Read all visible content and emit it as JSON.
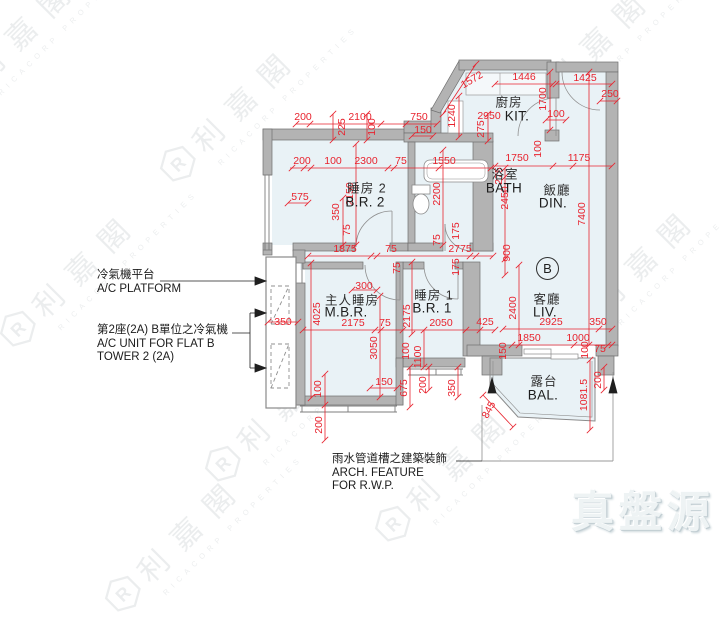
{
  "watermark": {
    "logo_letter": "R",
    "company_zh": "利嘉閣",
    "company_en": "RICACORP PROPERTIES"
  },
  "brand": {
    "logo_text": "真盤源"
  },
  "unit_badge": "B",
  "annotations": {
    "ac_platform_zh": "冷氣機平台",
    "ac_platform_en": "A/C PLATFORM",
    "ac_unit_zh": "第2座(2A) B單位之冷氣機",
    "ac_unit_en1": "A/C UNIT FOR FLAT B",
    "ac_unit_en2": "TOWER 2 (2A)",
    "arch_zh": "雨水管道槽之建築裝飾",
    "arch_en1": "ARCH. FEATURE",
    "arch_en2": "FOR R.W.P."
  },
  "rooms": [
    {
      "zh": "廚房",
      "zx": 509,
      "zy": 101,
      "en": "KIT.",
      "ex": 517,
      "ey": 116
    },
    {
      "zh": "睡房 2",
      "zx": 367,
      "zy": 187,
      "en": "B.R. 2",
      "ex": 365,
      "ey": 202
    },
    {
      "zh": "浴室",
      "zx": 505,
      "zy": 173,
      "en": "BATH",
      "ex": 504,
      "ey": 188
    },
    {
      "zh": "飯廳",
      "zx": 557,
      "zy": 189,
      "en": "DIN.",
      "ex": 553,
      "ey": 203
    },
    {
      "zh": "主人睡房",
      "zx": 352,
      "zy": 299,
      "en": "M.B.R.",
      "ex": 346,
      "ey": 312
    },
    {
      "zh": "睡房 1",
      "zx": 434,
      "zy": 294,
      "en": "B.R. 1",
      "ex": 432,
      "ey": 308
    },
    {
      "zh": "客廳",
      "zx": 547,
      "zy": 298,
      "en": "LIV.",
      "ex": 545,
      "ey": 312
    },
    {
      "zh": "露台",
      "zx": 544,
      "zy": 380,
      "en": "BAL.",
      "ex": 543,
      "ey": 395
    }
  ],
  "dimensions": [
    {
      "v": "200",
      "x": 303,
      "y": 117
    },
    {
      "v": "2100",
      "x": 360,
      "y": 117
    },
    {
      "v": "750",
      "x": 419,
      "y": 117
    },
    {
      "v": "225",
      "x": 342,
      "y": 127,
      "r": -90
    },
    {
      "v": "100",
      "x": 372,
      "y": 127,
      "r": -90
    },
    {
      "v": "150",
      "x": 423,
      "y": 130
    },
    {
      "v": "1572",
      "x": 472,
      "y": 80,
      "r": -30
    },
    {
      "v": "1446",
      "x": 524,
      "y": 77
    },
    {
      "v": "1425",
      "x": 585,
      "y": 78
    },
    {
      "v": "250",
      "x": 610,
      "y": 94
    },
    {
      "v": "1240",
      "x": 452,
      "y": 116,
      "r": -90
    },
    {
      "v": "2950",
      "x": 489,
      "y": 116
    },
    {
      "v": "275",
      "x": 481,
      "y": 129,
      "r": -90
    },
    {
      "v": "1700",
      "x": 543,
      "y": 99,
      "r": -90
    },
    {
      "v": "100",
      "x": 556,
      "y": 114
    },
    {
      "v": "200",
      "x": 302,
      "y": 161
    },
    {
      "v": "100",
      "x": 333,
      "y": 161
    },
    {
      "v": "2300",
      "x": 366,
      "y": 161
    },
    {
      "v": "75",
      "x": 401,
      "y": 161
    },
    {
      "v": "1550",
      "x": 444,
      "y": 161
    },
    {
      "v": "1750",
      "x": 517,
      "y": 158
    },
    {
      "v": "100",
      "x": 538,
      "y": 149,
      "r": -90
    },
    {
      "v": "1175",
      "x": 579,
      "y": 158
    },
    {
      "v": "575",
      "x": 300,
      "y": 197
    },
    {
      "v": "2150",
      "x": 350,
      "y": 194,
      "r": -90
    },
    {
      "v": "350",
      "x": 336,
      "y": 212,
      "r": -90
    },
    {
      "v": "75",
      "x": 347,
      "y": 230,
      "r": -90
    },
    {
      "v": "2200",
      "x": 437,
      "y": 194,
      "r": -90
    },
    {
      "v": "275",
      "x": 499,
      "y": 176,
      "r": -90
    },
    {
      "v": "2450",
      "x": 505,
      "y": 198,
      "r": -90
    },
    {
      "v": "7400",
      "x": 582,
      "y": 214,
      "r": -90
    },
    {
      "v": "1875",
      "x": 345,
      "y": 249
    },
    {
      "v": "75",
      "x": 391,
      "y": 249
    },
    {
      "v": "2775",
      "x": 460,
      "y": 249
    },
    {
      "v": "75",
      "x": 437,
      "y": 240,
      "r": -90
    },
    {
      "v": "175",
      "x": 456,
      "y": 231,
      "r": -90
    },
    {
      "v": "900",
      "x": 507,
      "y": 253,
      "r": -90
    },
    {
      "v": "75",
      "x": 397,
      "y": 268,
      "r": -90
    },
    {
      "v": "175",
      "x": 456,
      "y": 267,
      "r": -90
    },
    {
      "v": "300",
      "x": 364,
      "y": 286
    },
    {
      "v": "4025",
      "x": 317,
      "y": 314,
      "r": -90
    },
    {
      "v": "350",
      "x": 283,
      "y": 322
    },
    {
      "v": "2175",
      "x": 353,
      "y": 323
    },
    {
      "v": "75",
      "x": 385,
      "y": 323
    },
    {
      "v": "2175",
      "x": 407,
      "y": 316,
      "r": -90
    },
    {
      "v": "2050",
      "x": 441,
      "y": 323
    },
    {
      "v": "425",
      "x": 485,
      "y": 322
    },
    {
      "v": "2400",
      "x": 513,
      "y": 308,
      "r": -90
    },
    {
      "v": "2925",
      "x": 551,
      "y": 322
    },
    {
      "v": "350",
      "x": 598,
      "y": 322
    },
    {
      "v": "3050",
      "x": 374,
      "y": 348,
      "r": -90
    },
    {
      "v": "100",
      "x": 406,
      "y": 351,
      "r": -90
    },
    {
      "v": "1100",
      "x": 418,
      "y": 357,
      "r": -90
    },
    {
      "v": "1850",
      "x": 529,
      "y": 338
    },
    {
      "v": "1000",
      "x": 578,
      "y": 338
    },
    {
      "v": "100",
      "x": 585,
      "y": 350,
      "r": -90
    },
    {
      "v": "75",
      "x": 600,
      "y": 349
    },
    {
      "v": "150",
      "x": 503,
      "y": 351,
      "r": -90
    },
    {
      "v": "100",
      "x": 318,
      "y": 389,
      "r": -90
    },
    {
      "v": "200",
      "x": 319,
      "y": 425,
      "r": -90
    },
    {
      "v": "150",
      "x": 384,
      "y": 382
    },
    {
      "v": "675",
      "x": 404,
      "y": 388,
      "r": -90
    },
    {
      "v": "200",
      "x": 423,
      "y": 385,
      "r": -90
    },
    {
      "v": "350",
      "x": 452,
      "y": 388,
      "r": -90
    },
    {
      "v": "845",
      "x": 489,
      "y": 410,
      "r": -62
    },
    {
      "v": "1081.5",
      "x": 584,
      "y": 395,
      "r": -90
    },
    {
      "v": "200",
      "x": 598,
      "y": 380,
      "r": -90
    }
  ],
  "colors": {
    "dimension_red": "#e8232e",
    "wall_gray": "#b3b3b3",
    "room_fill": "#e9f2f6"
  }
}
